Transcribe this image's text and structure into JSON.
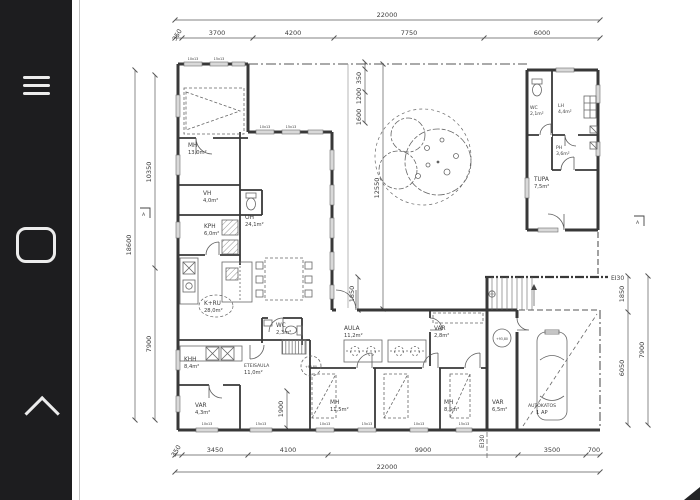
{
  "app": {
    "colors": {
      "sidebar_bg": "#1d1d1f",
      "icon": "#ececec",
      "paper": "#ffffff",
      "ink": "#3a3a3a"
    }
  },
  "sidebar": {
    "icons": [
      {
        "name": "menu-icon"
      },
      {
        "name": "shape-tool-icon"
      },
      {
        "name": "collapse-up-icon"
      }
    ]
  },
  "dims": {
    "top": {
      "overall": "22000",
      "segs": [
        "350",
        "3700",
        "4200",
        "7750",
        "6000"
      ]
    },
    "bottom": {
      "overall": "22000",
      "segs": [
        "350",
        "3450",
        "4100",
        "9900",
        "3500",
        "700"
      ]
    },
    "left": {
      "overall": "18600",
      "segs": [
        "10350",
        "7900"
      ]
    },
    "right": {
      "overall": "7900",
      "segs": [
        "1850",
        "6050"
      ]
    },
    "inner": {
      "a": "350",
      "b": "1200",
      "c": "1600",
      "d": "12550",
      "e": "1850",
      "f": "1900"
    }
  },
  "rooms": {
    "mh1": {
      "label": "MH",
      "area": "13,0m²"
    },
    "vh": {
      "label": "VH",
      "area": "4,0m²"
    },
    "kph": {
      "label": "KPH",
      "area": "6,0m²"
    },
    "oh": {
      "label": "OH",
      "area": "24,1m²"
    },
    "kru": {
      "label": "K+RU",
      "area": "28,0m²"
    },
    "wc1": {
      "label": "WC",
      "area": "2,3m²"
    },
    "khh": {
      "label": "KHH",
      "area": "8,4m²"
    },
    "eteisaula": {
      "label": "ETEISAULA",
      "area": "11,0m²"
    },
    "var1": {
      "label": "VAR",
      "area": "4,3m²"
    },
    "aula": {
      "label": "AULA",
      "area": "11,2m²"
    },
    "var2": {
      "label": "VAR",
      "area": "2,8m²"
    },
    "mh2": {
      "label": "MH",
      "area": "11,5m²"
    },
    "mh3": {
      "label": "MH",
      "area": "8,5m²"
    },
    "var3": {
      "label": "VAR",
      "area": "6,5m²"
    },
    "autokatos": {
      "label": "AUTOKATOS",
      "area": "1 AP"
    },
    "wc2": {
      "label": "WC",
      "area": "2,1m²"
    },
    "lh": {
      "label": "LH",
      "area": "4,4m²"
    },
    "ph": {
      "label": "PH",
      "area": "3,6m²"
    },
    "tupa": {
      "label": "TUPA",
      "area": "7,5m²"
    }
  },
  "markers": {
    "section": "A",
    "fire": "EI30",
    "level": "+93,80",
    "window_code": "10x13",
    "window_code2": "15x13"
  }
}
